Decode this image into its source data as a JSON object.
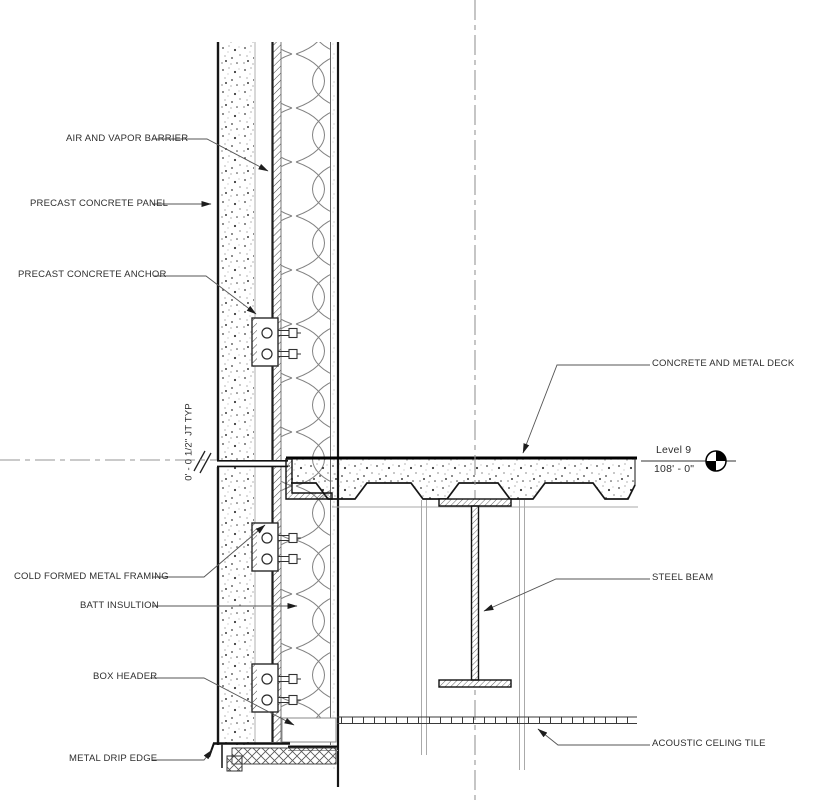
{
  "drawing": {
    "type": "architectural-wall-section-detail",
    "annotations": {
      "air_vapor_barrier": "AIR AND VAPOR BARRIER",
      "precast_concrete_panel": "PRECAST CONCRETE PANEL",
      "precast_concrete_anchor": "PRECAST CONCRETE ANCHOR",
      "joint_typ": "0' - 0 1/2\" JT TYP",
      "concrete_metal_deck": "CONCRETE AND METAL DECK",
      "cold_formed_metal_framing": "COLD FORMED METAL FRAMING",
      "batt_insulation": "BATT INSULTION",
      "box_header": "BOX HEADER",
      "metal_drip_edge": "METAL DRIP EDGE",
      "steel_beam": "STEEL BEAM",
      "acoustic_ceiling_tile": "ACOUSTIC CELING TILE"
    },
    "level_marker": {
      "name": "Level 9",
      "elevation": "108' - 0\""
    },
    "colors": {
      "background": "#ffffff",
      "line_heavy": "#161616",
      "line_light": "#9a9a9a",
      "text": "#2e2e2e"
    }
  }
}
